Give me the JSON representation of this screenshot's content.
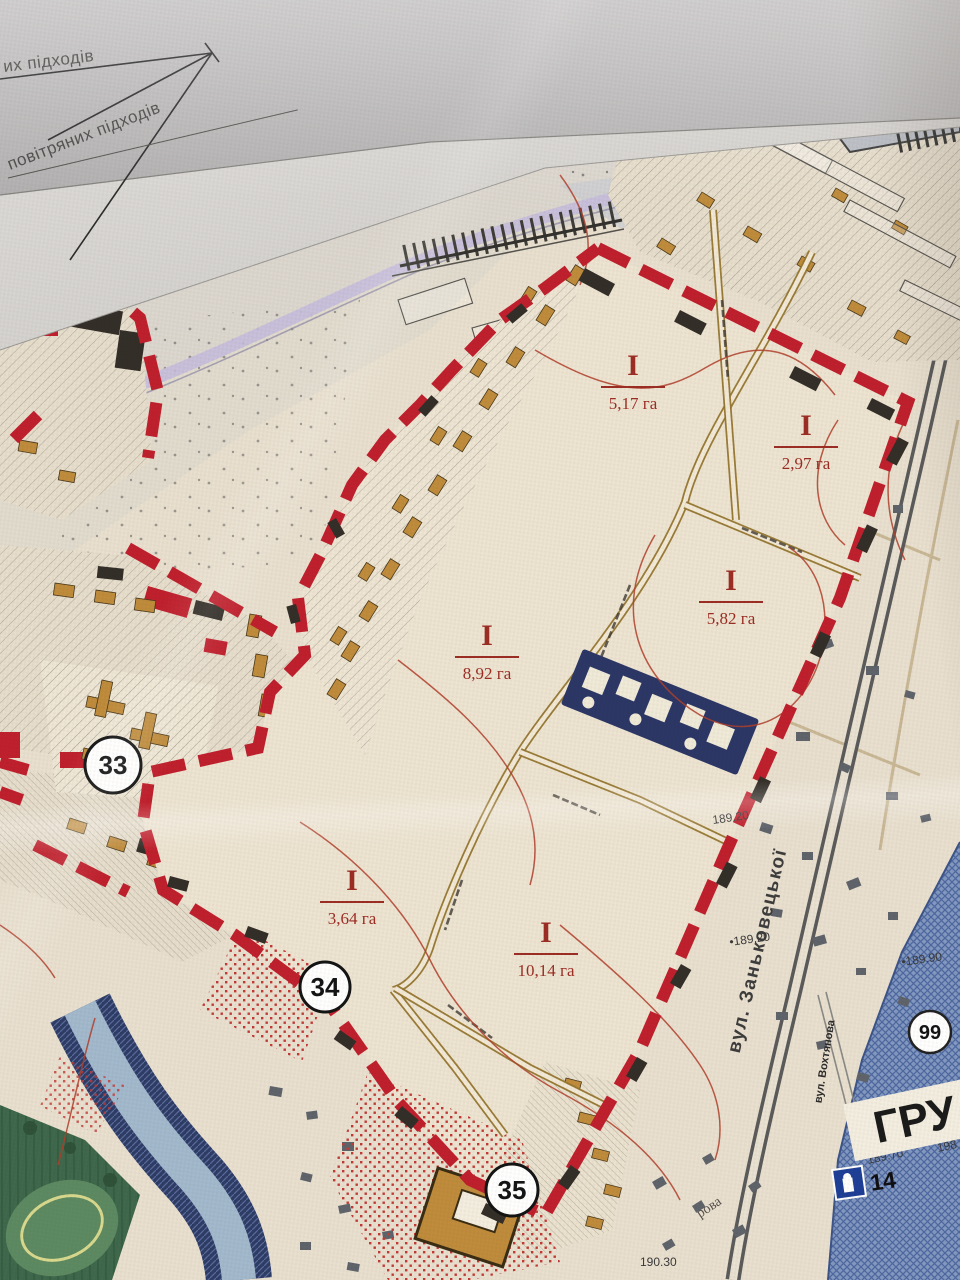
{
  "photo_header": {
    "label_top": "их підходів",
    "label_bottom": "повітряних підходів"
  },
  "parcels": [
    {
      "numeral": "I",
      "area": "5,17 га"
    },
    {
      "numeral": "I",
      "area": "2,97 га"
    },
    {
      "numeral": "I",
      "area": "8,92 га"
    },
    {
      "numeral": "I",
      "area": "5,82 га"
    },
    {
      "numeral": "I",
      "area": "3,64 га"
    },
    {
      "numeral": "I",
      "area": "10,14 га"
    }
  ],
  "markers": {
    "m33": "33",
    "m34": "34",
    "m35": "35",
    "m99": "99",
    "m14": "14"
  },
  "streets": {
    "zankovetska": "вул. Заньковецької",
    "vokhtyanova": "вул. Вохтянова",
    "fragment": "рова"
  },
  "district_label": "ГРУ",
  "elevations": {
    "e1": "189.20",
    "e2": "•189.20",
    "e3": "•189.90",
    "e4": "189.70",
    "e5": "198",
    "e6": "190.30"
  },
  "colors": {
    "paper": "#eae2d3",
    "fold_gray": "#bdbbba",
    "boundary_red": "#c0202d",
    "parcel_label": "#9c2d24",
    "navy_block": "#2c3766",
    "blue_district": "#7b92bb",
    "river": "#a3b9cd",
    "park_green": "#41684d",
    "building_tan": "#c08c3c",
    "shore_lavender": "#c6bedd"
  }
}
